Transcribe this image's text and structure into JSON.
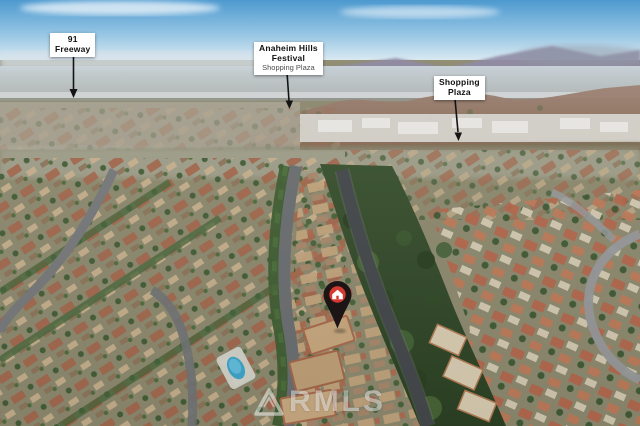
{
  "scene": {
    "type": "aerial-neighborhood-photo",
    "colors": {
      "sky": "#4494cd",
      "distant_mountains": "#8d87a5",
      "foothills": "#8a6a55",
      "greenbelt": "#33492b",
      "roof_terracotta": "#a4674c",
      "roof_tan": "#c9b18d",
      "road_asphalt": "#55585b",
      "pool_water": "#3fa6cb"
    }
  },
  "labels": {
    "freeway": {
      "title": "91\nFreeway"
    },
    "festival": {
      "title": "Anaheim Hills\nFestival",
      "subtitle": "Shopping Plaza"
    },
    "plaza": {
      "title": "Shopping\nPlaza"
    }
  },
  "marker": {
    "type": "location-pin",
    "icon": "house-icon",
    "pin_color": "#1d1416",
    "badge_color": "#d6392f",
    "icon_color": "#ffffff"
  },
  "watermark": {
    "text": "RMLS",
    "logo": "triangle-logo",
    "color": "rgba(255,255,255,0.48)"
  }
}
